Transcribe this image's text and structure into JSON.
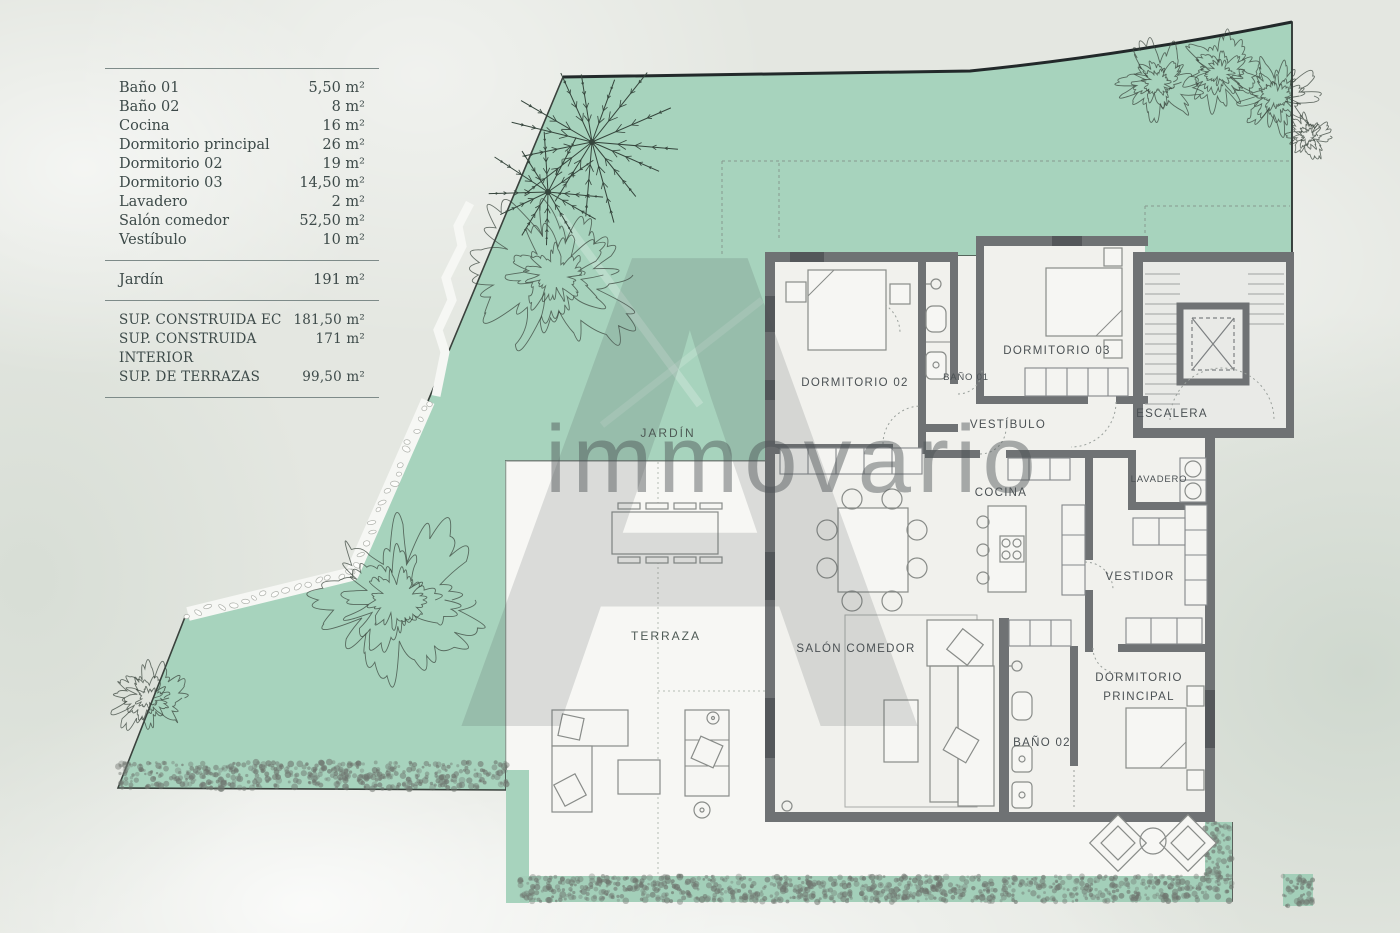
{
  "legend": {
    "rows": [
      {
        "label": "Baño 01",
        "value": "5,50 m²"
      },
      {
        "label": "Baño 02",
        "value": "8 m²"
      },
      {
        "label": "Cocina",
        "value": "16 m²"
      },
      {
        "label": "Dormitorio principal",
        "value": "26 m²"
      },
      {
        "label": "Dormitorio 02",
        "value": "19 m²"
      },
      {
        "label": "Dormitorio 03",
        "value": "14,50 m²"
      },
      {
        "label": "Lavadero",
        "value": "2 m²"
      },
      {
        "label": "Salón comedor",
        "value": "52,50 m²"
      },
      {
        "label": "Vestíbulo",
        "value": "10 m²"
      }
    ],
    "garden_row": {
      "label": "Jardín",
      "value": "191 m²"
    },
    "totals": [
      {
        "label": "SUP. CONSTRUIDA EC",
        "value": "181,50 m²"
      },
      {
        "label": "SUP. CONSTRUIDA INTERIOR",
        "value": "171 m²"
      },
      {
        "label": "SUP. DE TERRAZAS",
        "value": "99,50 m²"
      }
    ]
  },
  "plan": {
    "rooms": {
      "jardin": "JARDÍN",
      "terraza": "TERRAZA",
      "dormitorio02": "DORMITORIO 02",
      "bano01": "BAÑO 01",
      "dormitorio03": "DORMITORIO 03",
      "escalera": "ESCALERA",
      "vestibulo": "VESTÍBULO",
      "cocina": "COCINA",
      "lavadero": "LAVADERO",
      "vestidor": "VESTIDOR",
      "salon": "SALÓN COMEDOR",
      "bano02": "BAÑO 02",
      "dorm_ppal_line1": "DORMITORIO",
      "dorm_ppal_line2": "PRINCIPAL"
    }
  },
  "watermark": {
    "logo_letter": "A",
    "brand": "immovario"
  },
  "colors": {
    "garden_green": "#a7d3bd",
    "hedge_scribble": "#79807a",
    "wall_gray": "#6f7274",
    "room_fill": "#f1f1ed",
    "stair_fill": "#e9eae7",
    "paper": "#e4e7e1",
    "label_text": "#4b5154"
  }
}
